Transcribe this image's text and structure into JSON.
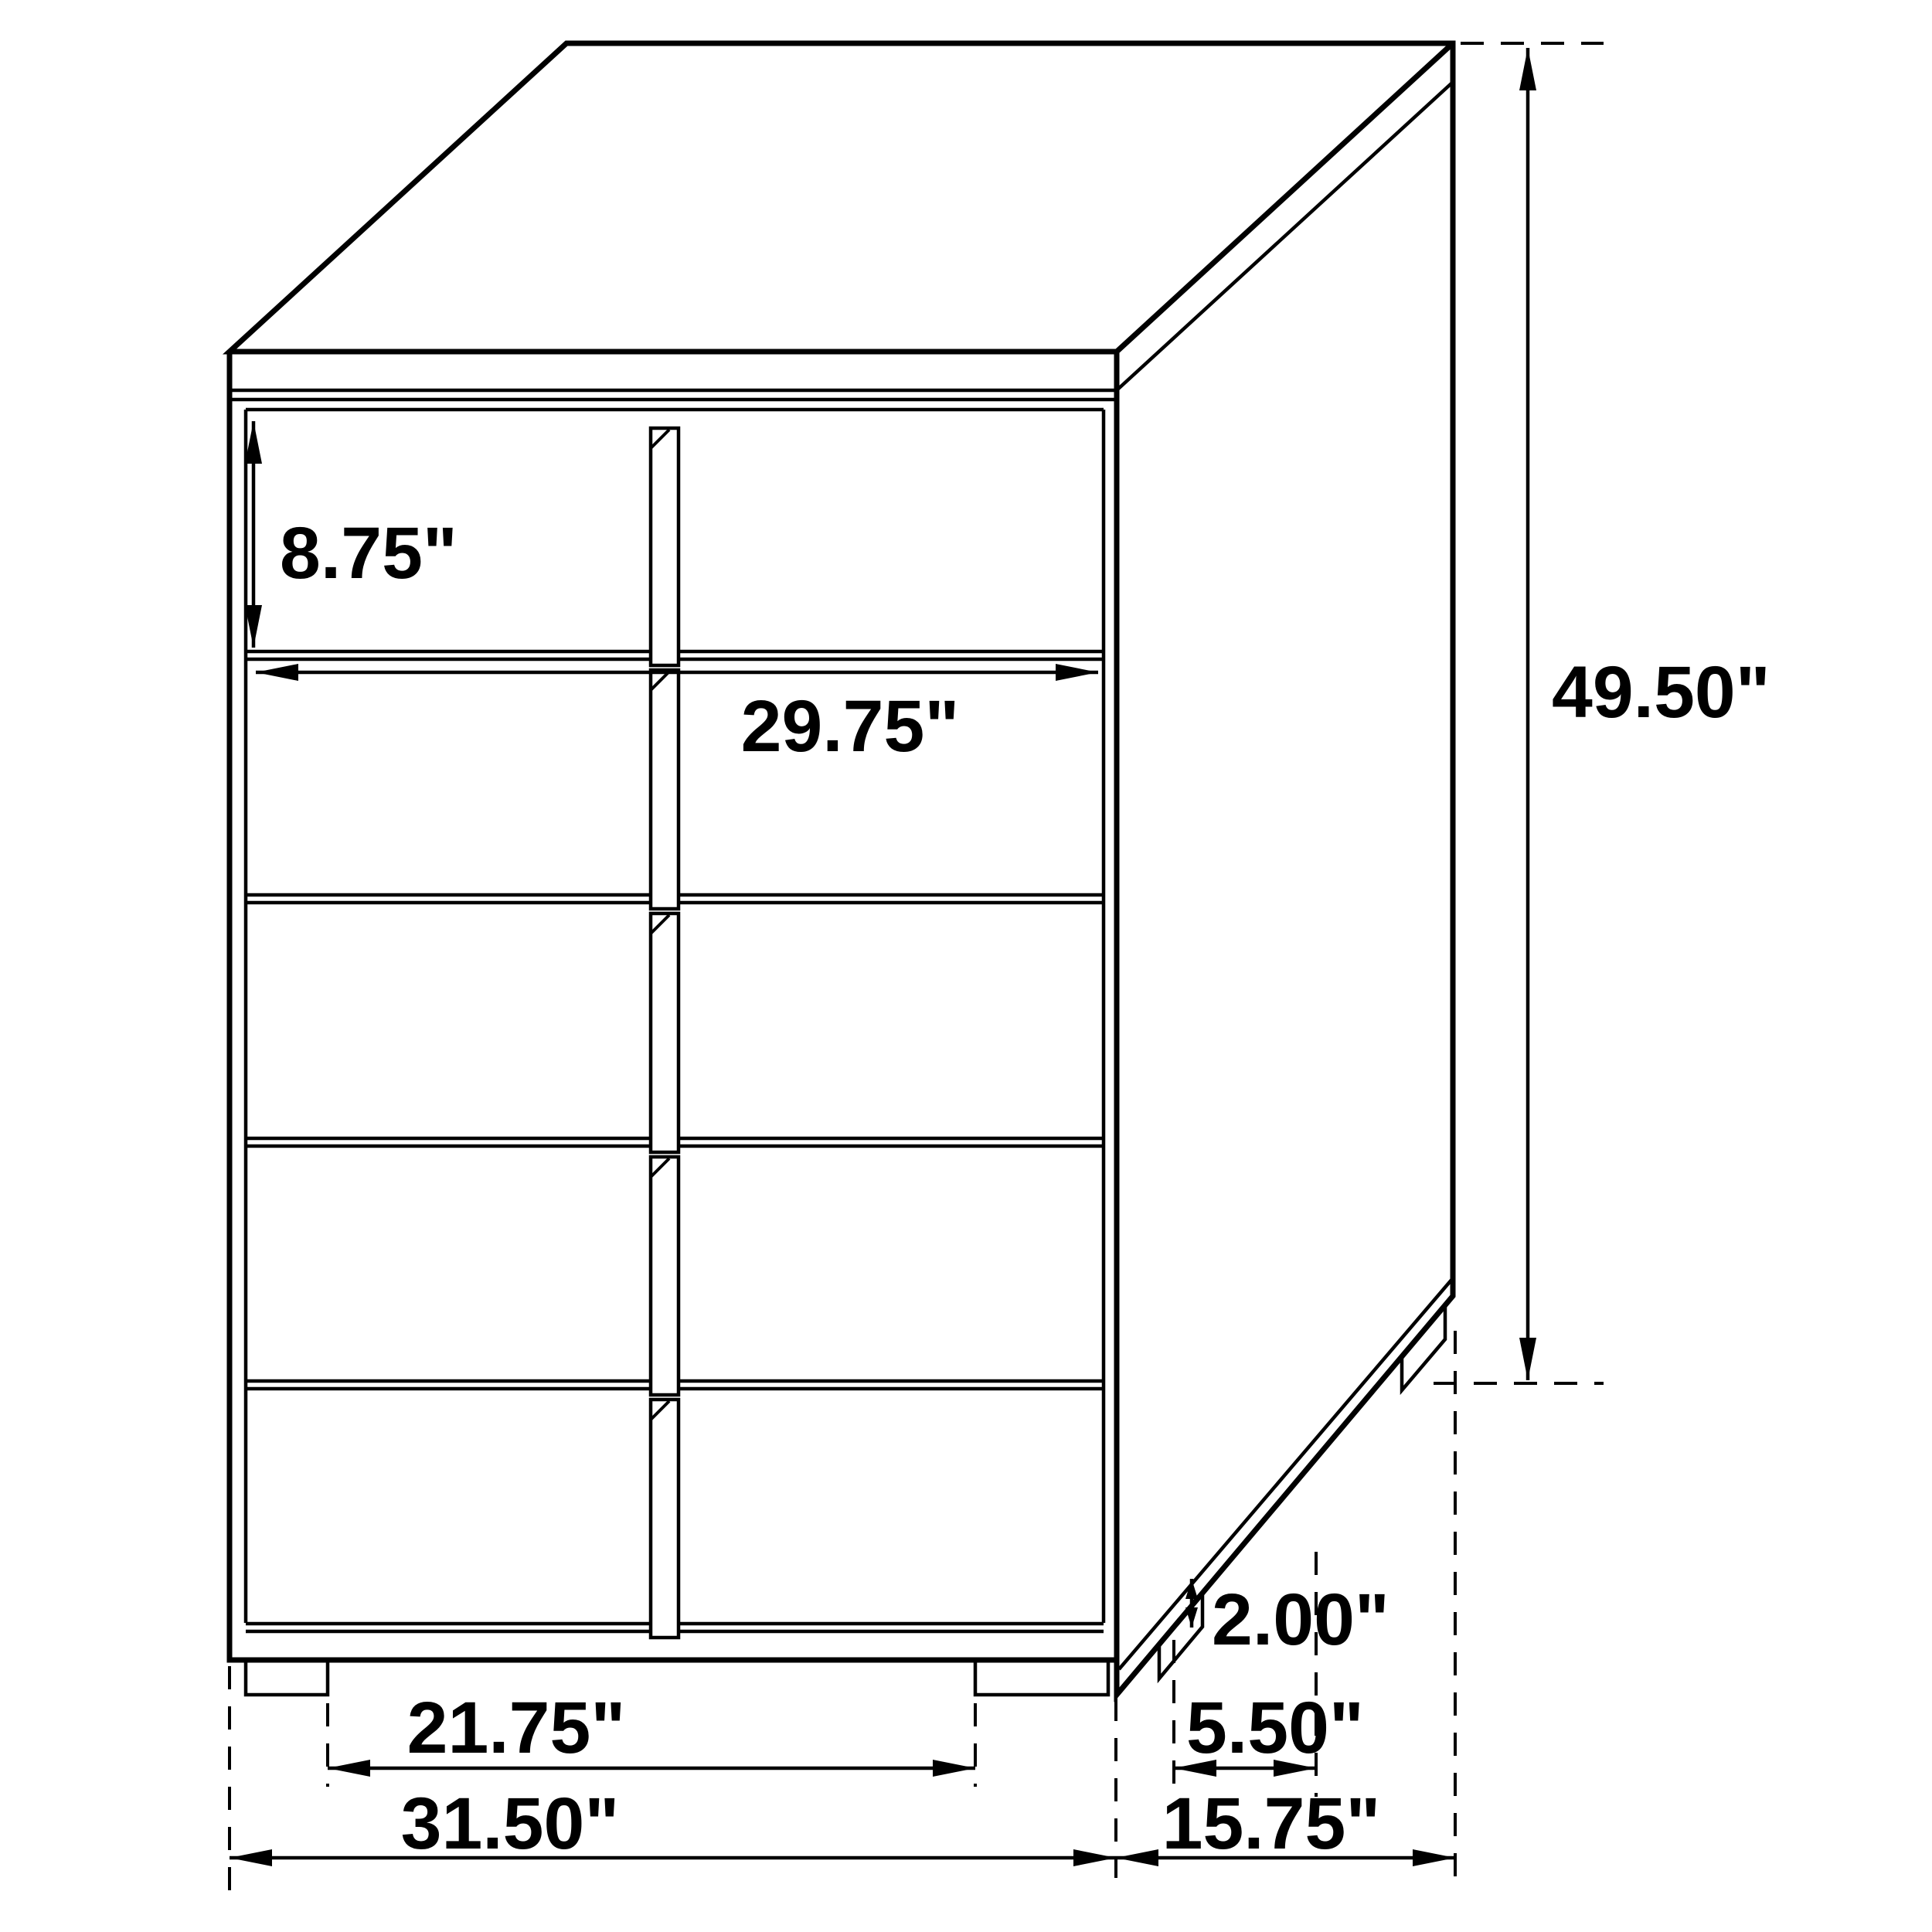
{
  "colors": {
    "line": "#000000",
    "background": "#ffffff"
  },
  "diagram": {
    "kind": "furniture-dimension-drawing",
    "views": "single perspective view of a five-drawer chest with split drawer fronts"
  },
  "dimensions": {
    "drawer_height": "8.75\"",
    "drawer_width": "29.75\"",
    "overall_height": "49.50\"",
    "leg_height": "2.00\"",
    "side_leg_inset": "5.50\"",
    "front_leg_span": "21.75\"",
    "overall_width": "31.50\"",
    "overall_depth": "15.75\""
  }
}
